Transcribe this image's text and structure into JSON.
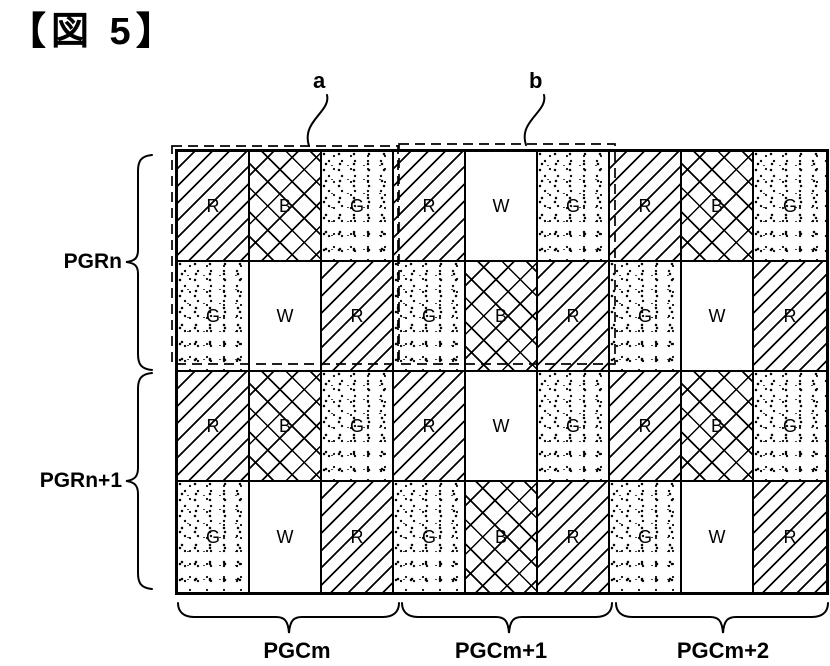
{
  "title": "【図 5】",
  "figure": {
    "region_labels": {
      "a": "a",
      "b": "b"
    },
    "row_groups": [
      {
        "label": "PGRn"
      },
      {
        "label": "PGRn+1"
      }
    ],
    "col_groups": [
      {
        "label": "PGCm"
      },
      {
        "label": "PGCm+1"
      },
      {
        "label": "PGCm+2"
      }
    ],
    "grid": {
      "columns": 9,
      "rows": [
        [
          "R",
          "B",
          "G",
          "R",
          "W",
          "G",
          "R",
          "B",
          "G"
        ],
        [
          "G",
          "W",
          "R",
          "G",
          "B",
          "R",
          "G",
          "W",
          "R"
        ],
        [
          "R",
          "B",
          "G",
          "R",
          "W",
          "G",
          "R",
          "B",
          "G"
        ],
        [
          "G",
          "W",
          "R",
          "G",
          "B",
          "R",
          "G",
          "W",
          "R"
        ]
      ],
      "patterns": {
        "R": "diagonal-hatch",
        "B": "cross-hatch",
        "G": "stipple-dots",
        "W": "plain-white"
      }
    },
    "colors": {
      "line": "#000000",
      "background": "#ffffff"
    }
  }
}
